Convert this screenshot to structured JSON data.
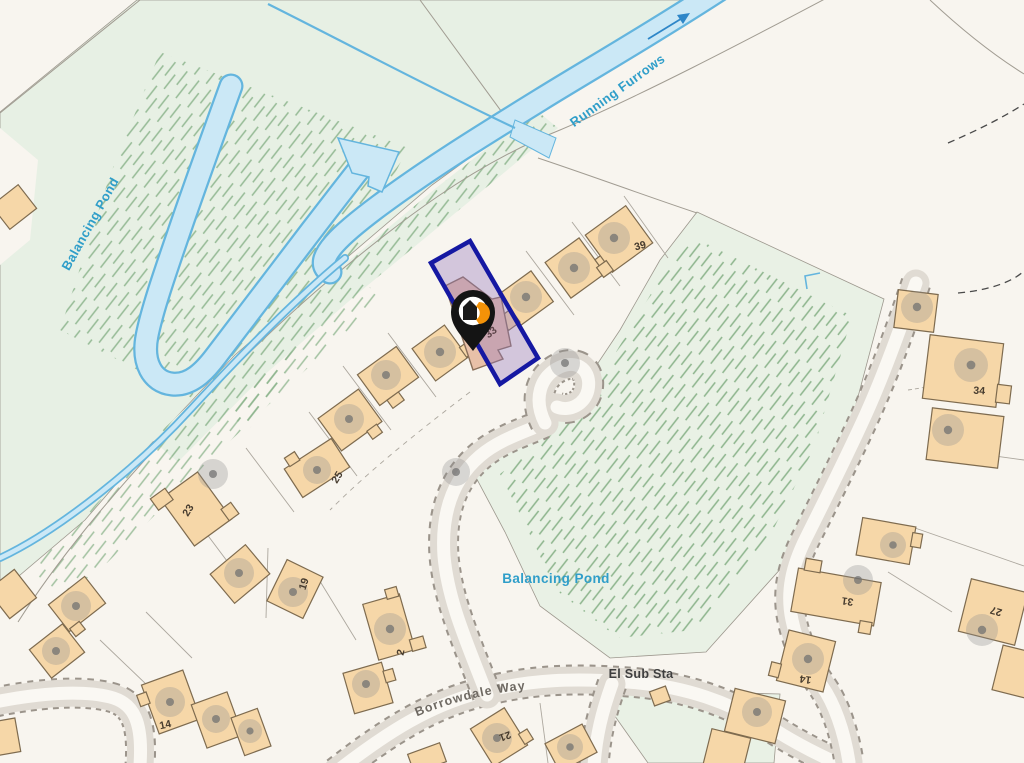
{
  "map": {
    "labels": {
      "balancing_pond_nw": "Balancing Pond",
      "running_furrows": "Running Furrows",
      "balancing_pond_se": "Balancing Pond",
      "el_sub_sta": "El Sub Sta",
      "borrowdale_way": "Borrowdale Way"
    },
    "house_numbers": {
      "n39": "39",
      "n33": "33",
      "n25": "25",
      "n23": "23",
      "n19": "19",
      "n2": "2",
      "n14_west": "14",
      "n21": "21",
      "n34": "34",
      "n31": "31",
      "n27": "27",
      "n14_east": "14"
    },
    "icons": {
      "marker": "property-pin-icon",
      "flow_arrow": "flow-direction-arrow-icon"
    },
    "colors": {
      "highlight_outline": "#1518A2",
      "highlight_fill": "#9678BE",
      "water_fill": "#CBE8F6",
      "water_stroke": "#64B5DE",
      "greenspace": "#E7F0E4",
      "building": "#F6D7A8",
      "selected_building": "#E8C0A8",
      "road_band": "#E0DBD3",
      "label_blue": "#2F9EC9",
      "pin_black": "#141414",
      "pin_accent": "#F39208"
    }
  }
}
